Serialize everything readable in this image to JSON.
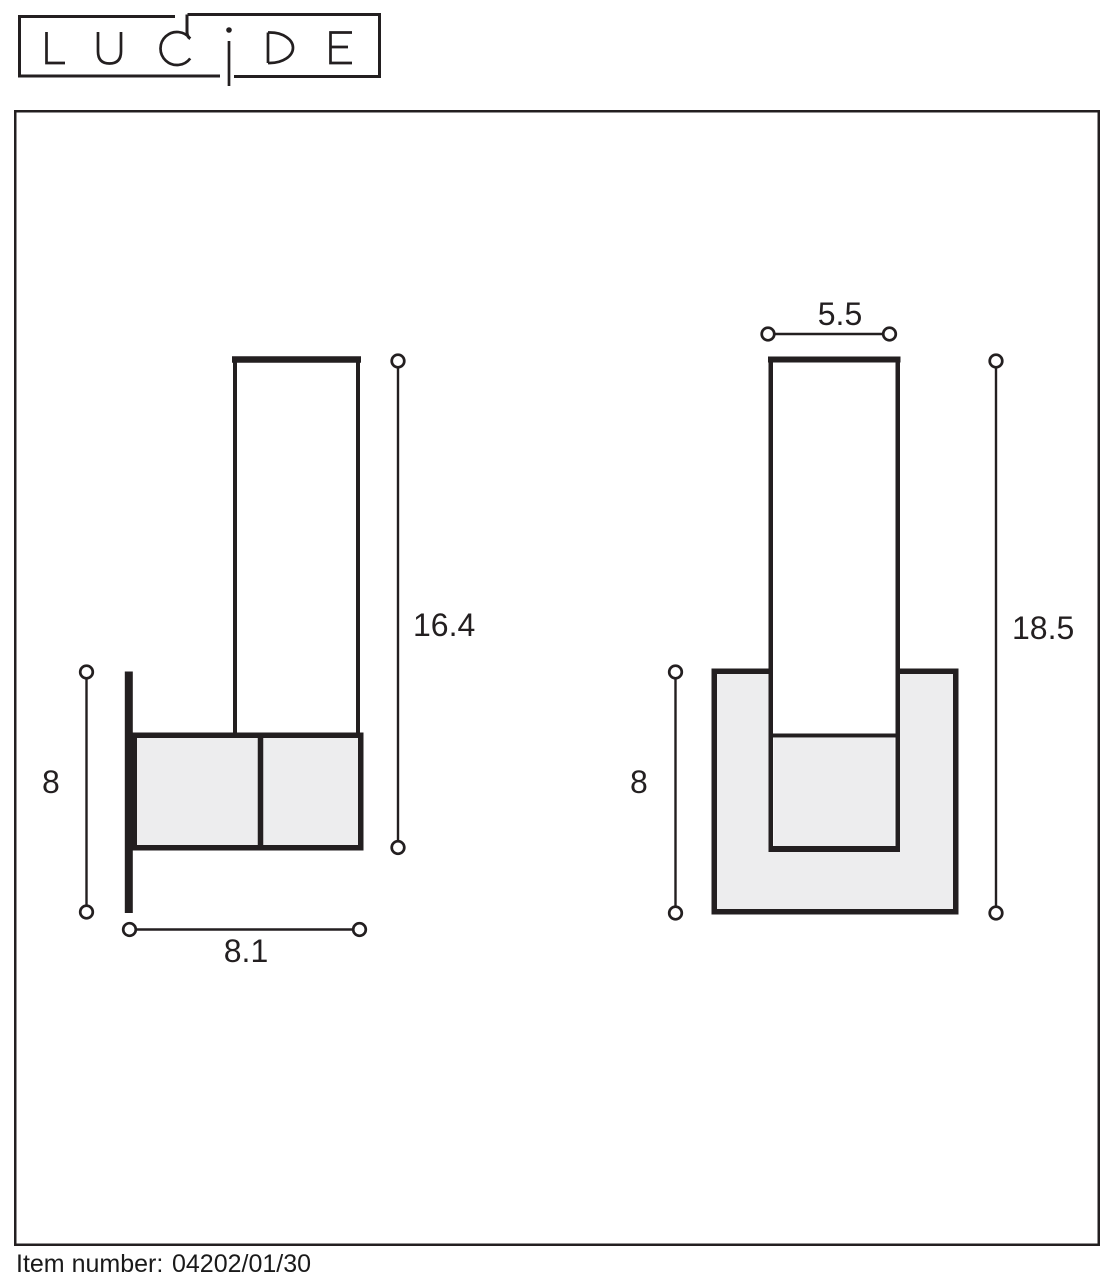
{
  "logo": {
    "brand": "LUCIDE"
  },
  "diagram": {
    "side_view": {
      "body_height": "16.4",
      "body_width": "8.1",
      "backplate_height": "8"
    },
    "front_view": {
      "tube_width": "5.5",
      "total_height": "18.5",
      "backplate_height": "8"
    }
  },
  "footer": {
    "item_number_label": "Item number:",
    "item_number_value": "04202/01/30"
  },
  "colors": {
    "ink": "#231f20",
    "panel_fill": "#ededee"
  }
}
